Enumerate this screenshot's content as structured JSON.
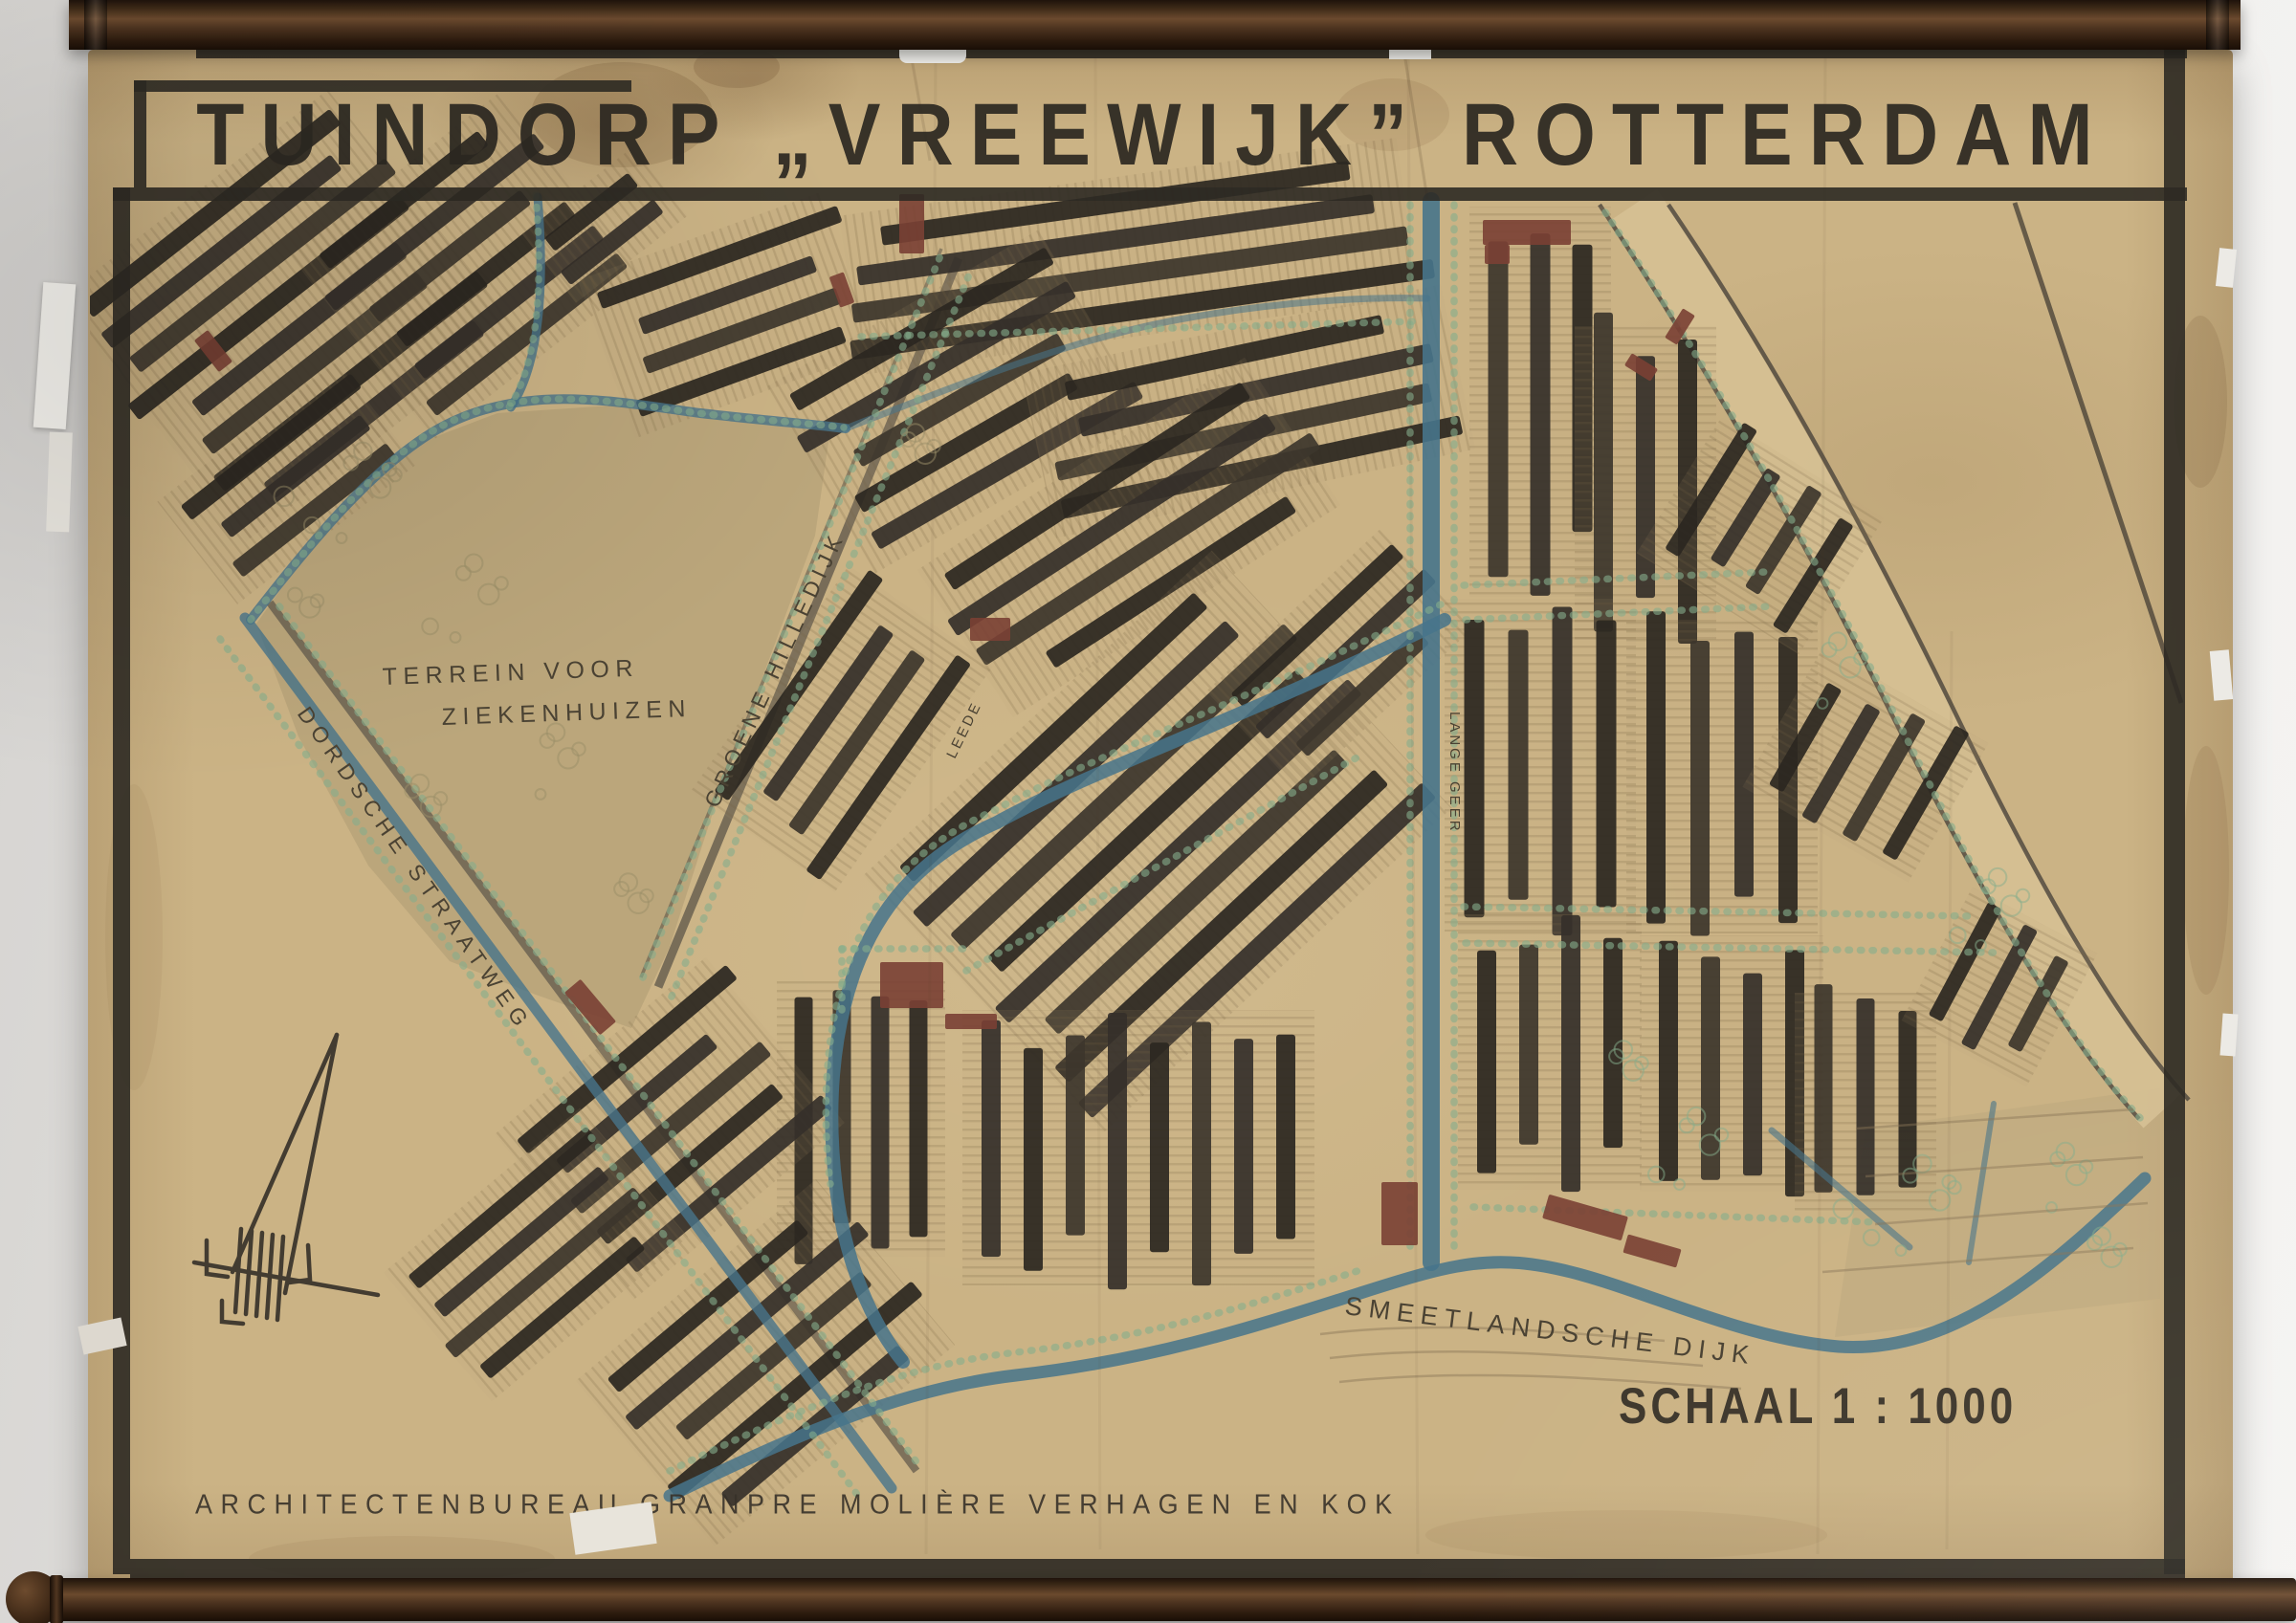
{
  "poster": {
    "title": "TUINDORP „VREEWIJK” ROTTERDAM",
    "scale_label": "SCHAAL 1 : 1000",
    "credit_line": "ARCHITECTENBUREAU GRANPRE MOLIÈRE VERHAGEN EN KOK"
  },
  "map_labels": {
    "terrain_line1": "TERREIN VOOR",
    "terrain_line2": "ZIEKENHUIZEN",
    "road_dordsche": "DORDSCHE STRAATWEG",
    "road_groene_hilledijk": "GROENE HILLEDIJK",
    "dyke_smeetlandsche": "SMEETLANDSCHE DIJK",
    "canal_leede": "LEEDE",
    "canal_lange_geer": "LANGE GEER"
  },
  "icons": {
    "north_arrow": "stylized-north-arrow"
  },
  "colors": {
    "paper": "#cbb385",
    "frame_ink": "#2e2a24",
    "building_dark": "#35302a",
    "building_red": "#7a4034",
    "canal_blue": "#47748b",
    "tree_green": "#86ad8c",
    "road_brown": "#544e45",
    "rod_wood": "#4a2f1c"
  }
}
